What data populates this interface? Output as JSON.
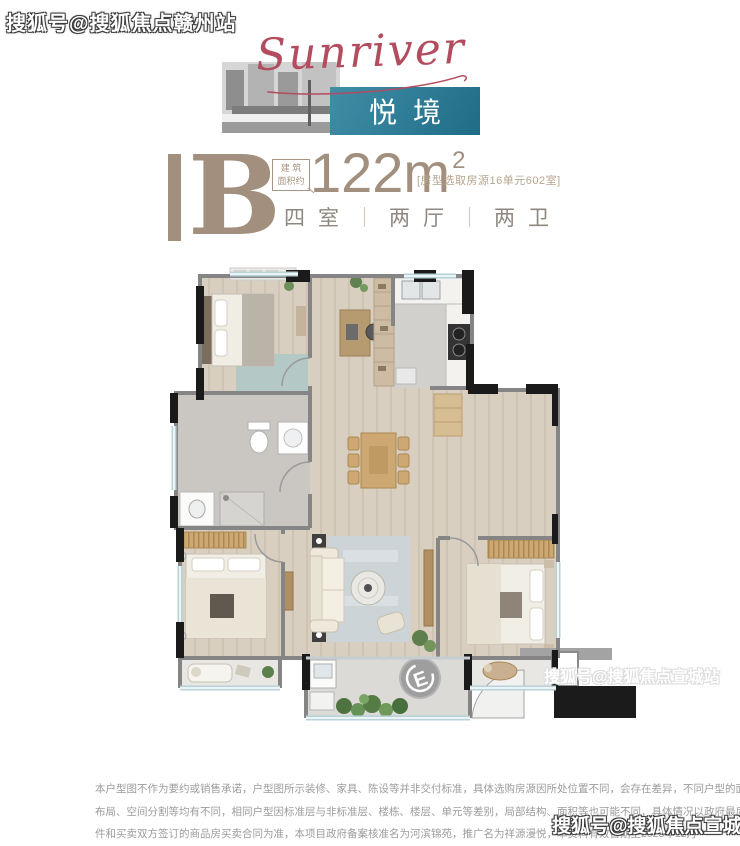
{
  "watermarks": {
    "top_left": "搜狐号@搜狐焦点赣州站",
    "middle_right": "搜狐号@搜狐焦点宣城站",
    "bottom_right": "搜狐号@搜狐焦点宣城站"
  },
  "header": {
    "brand_script": "Sunriver",
    "product_name": "悦境"
  },
  "unit": {
    "letter": "B",
    "area_label_top": "建 筑",
    "area_label_bottom": "面积约",
    "area_number": "122m",
    "area_power": "2",
    "source_note": "[房型选取房源16单元602室]",
    "layout": {
      "rooms": "四室",
      "halls": "两厅",
      "baths": "两卫"
    }
  },
  "floorplan": {
    "compass_label": "E"
  },
  "disclaimer": {
    "lines": [
      "本户型图不作为要约或销售承诺，户型图所示装修、家具、陈设等并非交付标准，具体选购房源因所处位置不同，会存在差异，不同户型的面积尺寸、功能",
      "布局、空间分割等均有不同，相同户型因标准层与非标准层、楼栋、楼层、单元等差别，局部结构、面积等也可能不同，具体情况以政府最后批准之法律文",
      "件和买卖双方签订的商品房买卖合同为准，本项目政府备案核准名为河滨锦苑，推广名为祥源漫悦，本资料有效日期至2023年12月"
    ]
  },
  "colors": {
    "teal": "#2f7e99",
    "maroon": "#b24c5e",
    "taupe": "#a28f7d",
    "text_gray": "#9c9c9c"
  }
}
